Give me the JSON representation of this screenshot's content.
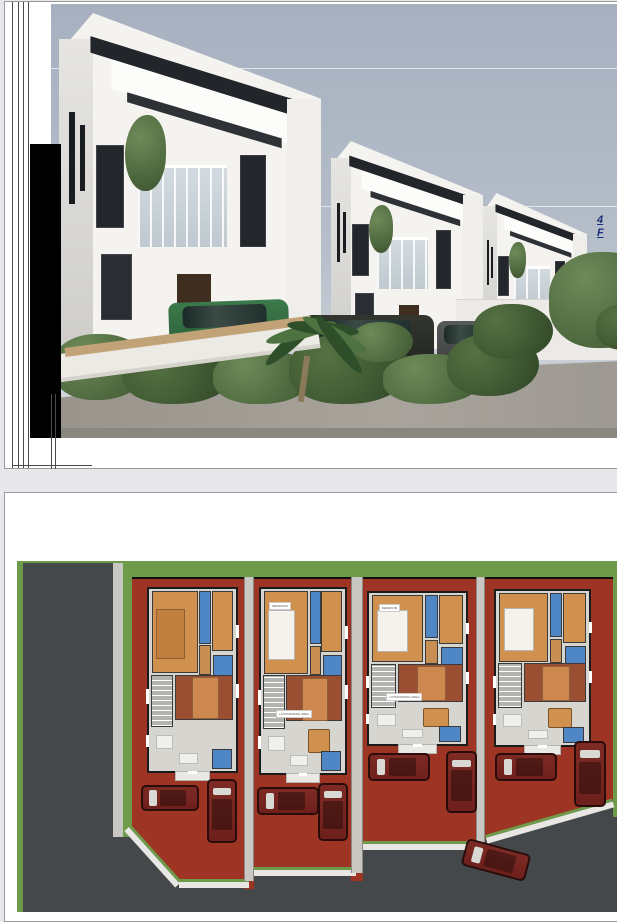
{
  "document": {
    "kind": "architectural-presentation",
    "page_count_visible": 2
  },
  "page1": {
    "content": "3d-exterior-render-of-three-duplex-houses",
    "annotation": {
      "line1": "4",
      "line2": "F"
    }
  },
  "page2": {
    "content": "site-floor-plan-of-four-terrace-units",
    "labels": {
      "bedroom": "BEDROOM",
      "living": "LIVING/DINING AREA"
    },
    "units": [
      {
        "x": 142,
        "y": 94,
        "w": 91,
        "h": 186,
        "bed_white": false,
        "table": false,
        "label_bed": "",
        "label_living": ""
      },
      {
        "x": 254,
        "y": 94,
        "w": 88,
        "h": 188,
        "bed_white": true,
        "table": true,
        "label_bed": "BEDROOM",
        "label_living": "LIVING/DINING AREA"
      },
      {
        "x": 362,
        "y": 98,
        "w": 101,
        "h": 155,
        "bed_white": true,
        "table": true,
        "label_bed": "BEDROOM",
        "label_living": "LIVING/DINING AREA"
      },
      {
        "x": 489,
        "y": 96,
        "w": 97,
        "h": 158,
        "bed_white": true,
        "table": true,
        "label_bed": "",
        "label_living": ""
      }
    ],
    "cars": [
      {
        "x": 136,
        "y": 292,
        "w": 58,
        "h": 26,
        "rot": 0
      },
      {
        "x": 202,
        "y": 286,
        "w": 30,
        "h": 64,
        "rot": 0
      },
      {
        "x": 252,
        "y": 294,
        "w": 62,
        "h": 28,
        "rot": 0
      },
      {
        "x": 313,
        "y": 290,
        "w": 30,
        "h": 58,
        "rot": 0
      },
      {
        "x": 363,
        "y": 260,
        "w": 62,
        "h": 28,
        "rot": 0
      },
      {
        "x": 441,
        "y": 258,
        "w": 31,
        "h": 62,
        "rot": 0
      },
      {
        "x": 490,
        "y": 260,
        "w": 62,
        "h": 28,
        "rot": 0
      },
      {
        "x": 569,
        "y": 248,
        "w": 32,
        "h": 66,
        "rot": 0
      },
      {
        "x": 458,
        "y": 353,
        "w": 66,
        "h": 28,
        "rot": 15
      }
    ]
  },
  "colors": {
    "canvas_bg": "#e8e8ec",
    "page_border": "#999999",
    "sky_top": "#a6b0bf",
    "sky_bottom": "#d6dade",
    "render_white": "#f4f3f0",
    "render_dark": "#22262a",
    "hedge_dark": "#3c5530",
    "hedge_light": "#6e8a58",
    "annotation_navy": "#1b2f7a",
    "plan_road": "#45484a",
    "plan_green": "#6d9b4a",
    "plan_red": "#9e3424",
    "plan_sidewalk": "#c8c7c2",
    "plan_floor": "#d6d5d0",
    "room_orange": "#d0914f",
    "room_blue": "#4e86c6",
    "room_brown": "#9a4f33",
    "bed_tan": "#cd8850",
    "stair_gray": "#b3b3b0",
    "car_maroon": "#6f201c"
  }
}
